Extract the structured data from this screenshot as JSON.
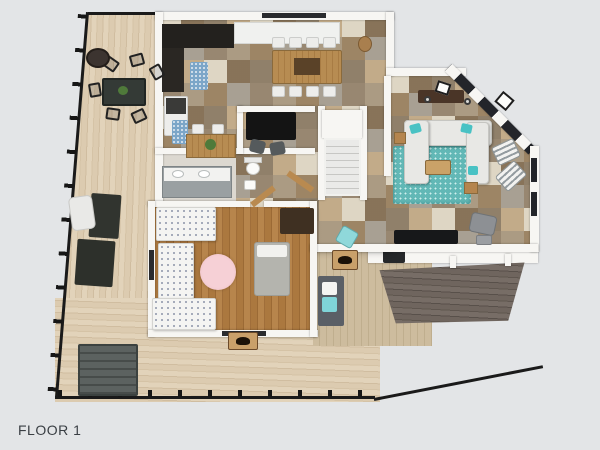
{
  "floor_plan": {
    "label": "FLOOR 1",
    "view": "3d-top-down-floor-plan-render",
    "background_color": "#e3e5e7",
    "palette": {
      "deck_wood": "#d9c8ac",
      "tile_light": "#ded6c4",
      "tile_dark": "#c2ab89",
      "bedroom_wood": "#a9773f",
      "wall_white": "#f7f6f3",
      "roof_shingle": "#6f655e",
      "rug_teal": "#62b8b6",
      "rug_pink": "#f0c3ca",
      "railing_black": "#1a1a1a",
      "porch_siding": "#c9b896",
      "cabinet_dark": "#23211e"
    },
    "regions": [
      "wrap-around-deck",
      "kitchen",
      "dining-room",
      "living-room",
      "bedroom",
      "bathroom",
      "powder-room",
      "office-nook",
      "staircase",
      "entry-porch",
      "porch-roof"
    ]
  }
}
